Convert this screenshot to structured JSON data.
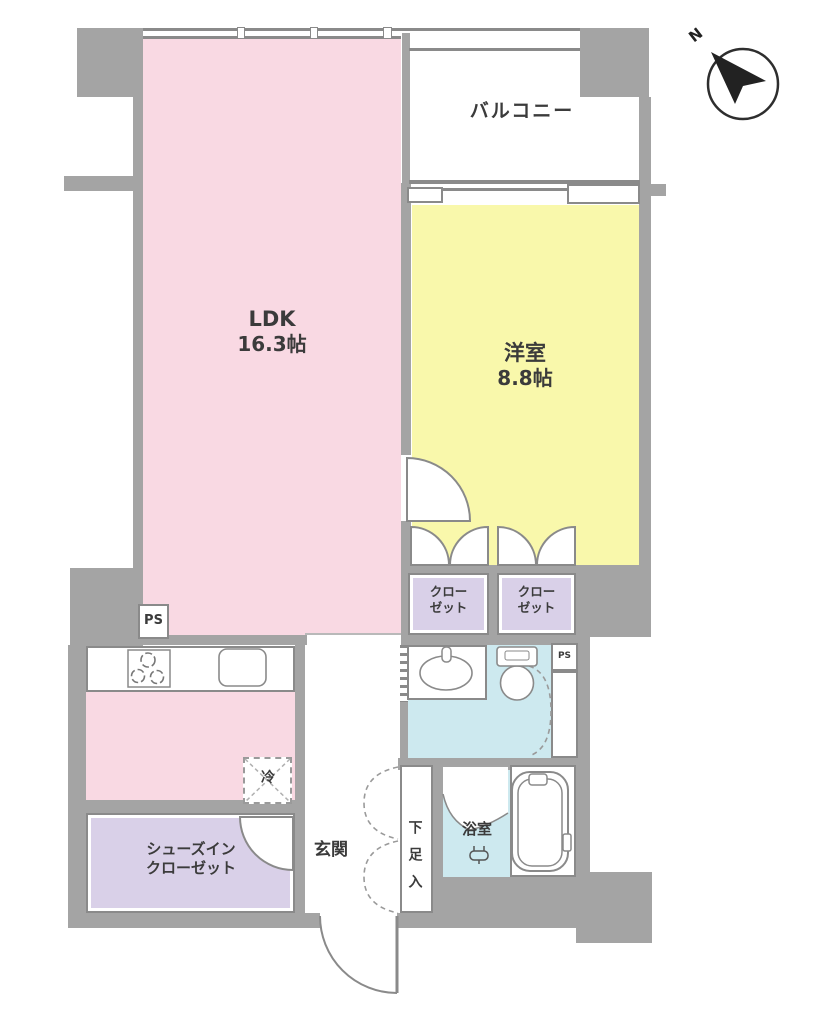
{
  "floorplan": {
    "compass": {
      "label": "N"
    },
    "rooms": {
      "ldk": {
        "name": "LDK",
        "size": "16.3帖"
      },
      "western_room": {
        "name": "洋室",
        "size": "8.8帖"
      },
      "balcony": {
        "name": "バルコニー"
      },
      "closet_left": {
        "name": "クローゼット"
      },
      "closet_right": {
        "name": "クローゼット"
      },
      "shoes_in_closet": {
        "name": "シューズインクローゼット"
      },
      "entrance": {
        "name": "玄関"
      },
      "shoe_cabinet": {
        "name": "下足入"
      },
      "bathroom": {
        "name": "浴室"
      },
      "refrigerator": {
        "name": "冷"
      },
      "pipe_space_left": {
        "name": "PS"
      },
      "pipe_space_right": {
        "name": "PS"
      }
    },
    "colors": {
      "ldk": "#f9d9e3",
      "western_room": "#f9f8ab",
      "closet": "#d9d0e8",
      "wet_area": "#cde9ef",
      "wall": "#a4a4a4",
      "line": "#8a8a8a",
      "text": "#3b3b3b"
    }
  }
}
